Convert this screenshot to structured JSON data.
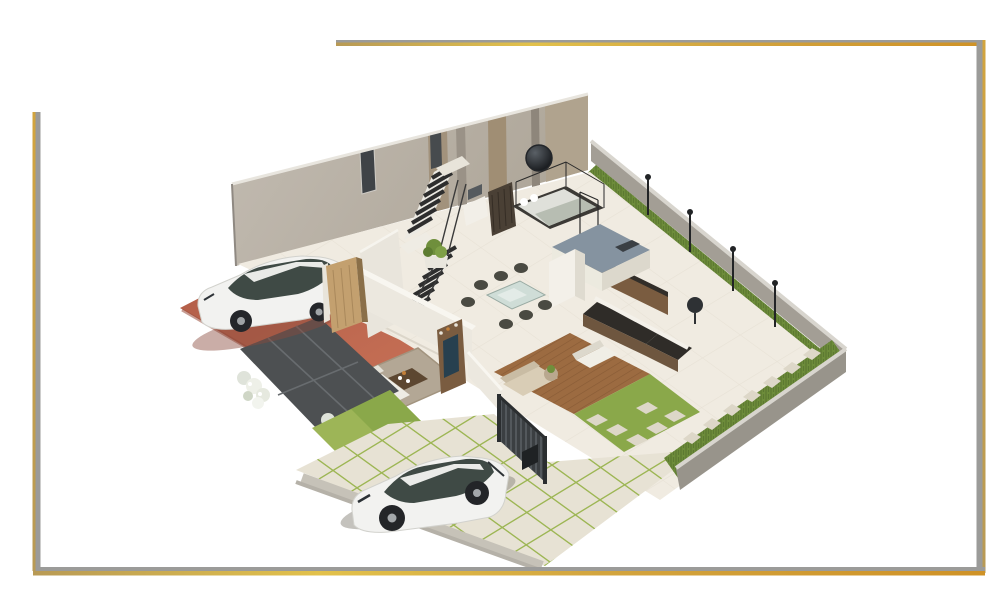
{
  "scene": {
    "description": "3D isometric render of a modern house ground-floor plan with two white hatchback cars, staircase, living room, dining set, kitchen, bedroom, wooden deck, lawns and boundary walls",
    "labels": {
      "frame": "gold and gray decorative frame lines",
      "back_wall": "tall back wall with wood panels and windows",
      "boundary_wall_ne": "north-east boundary wall",
      "boundary_wall_se": "south-east boundary wall",
      "hedge": "hedge and grass strip along boundary wall",
      "lamps": "garden lamp posts",
      "floor": "interior tiled floor",
      "bedroom": "bedroom with bed and round wall art",
      "stairs": "staircase with dark treads",
      "kitchen": "kitchen with island, cabinets and counters",
      "dining": "glass dining table with chairs",
      "living": "living room with sofa, rug, coffee table and TV shelf",
      "deck": "wooden deck with outdoor furniture",
      "fence": "dark slatted fence",
      "red_driveway": "terracotta side driveway",
      "patio": "charcoal tiled patio",
      "shrubs": "white flowering shrubs",
      "lawn": "lawn patch",
      "pavers": "paved front driveway with grass joints",
      "car_side": "white hatchback car on side driveway",
      "car_front": "white hatchback car on front driveway",
      "door": "open wooden entry door",
      "stones": "stepping stones"
    },
    "palette": {
      "back_wall": "#b8b1a6",
      "wall_wood_panel": "#a2927c",
      "window_glass": "#3f4347",
      "boundary_wall": "#a39e95",
      "boundary_wall_dark": "#98948b",
      "coping": "#d8d5ce",
      "hedge": "#6d8c3a",
      "lawn": "#9db557",
      "lawn_dark": "#8aa84a",
      "interior_floor": "#f0ebe1",
      "interior_wall": "#ece8df",
      "wall_face_gray": "#b7b2a9",
      "red_driveway": "#bc654f",
      "charcoal_patio": "#4d5052",
      "paver": "#e7e2d4",
      "paver_joint": "#9db654",
      "deck_wood": "#9c6b41",
      "door_wood": "#c3a06f",
      "car_body": "#f2f2f0",
      "car_glass": "#3f4a45",
      "dark_metal": "#3b3f42",
      "white_sofa": "#f2f0e9",
      "beige_sofa": "#d9cdb6",
      "rug": "#b3a795",
      "wood_furniture": "#7a5c40",
      "counter_dark": "#2f2c28",
      "island_top": "#8593a0",
      "stair_stringer": "#e9e5dc",
      "stair_tread": "#2e2e2e",
      "bed_blanket": "#b7bdb2",
      "shrub_white": "#eef0e8"
    },
    "frame": {
      "gray": "#9b9b99",
      "gold": "#d2a43e",
      "gold_light": "#e2c14b",
      "gold_dark": "#cf9226",
      "gold_tan": "#b89a55"
    }
  }
}
